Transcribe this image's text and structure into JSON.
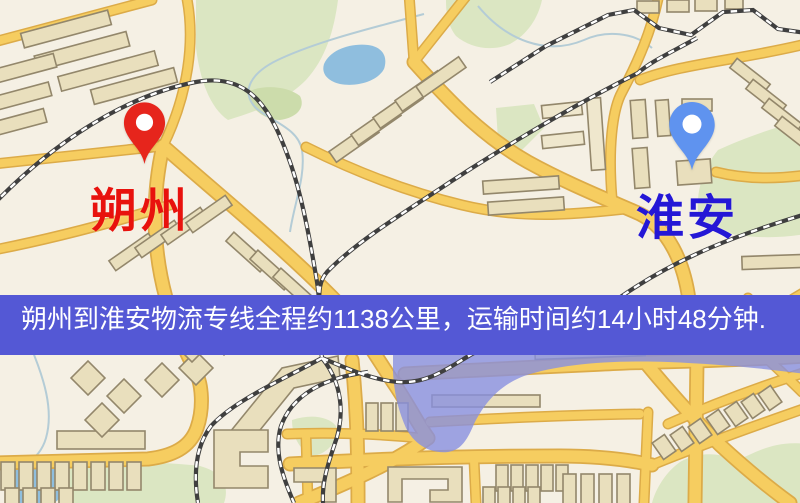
{
  "banner": {
    "text": "朔州到淮安物流专线全程约1138公里，运输时间约14小时48分钟.",
    "background": "#5458d5",
    "text_color": "#ffffff"
  },
  "markers": {
    "origin": {
      "label": "朔州",
      "pin_color": "#e6251c",
      "label_color": "#e8120d"
    },
    "destination": {
      "label": "淮安",
      "pin_color": "#5f93ef",
      "label_color": "#2417d6"
    }
  },
  "route": {
    "origin": "朔州",
    "destination": "淮安",
    "distance": "约1138公里",
    "duration": "约14小时48分钟"
  },
  "map_colors": {
    "background": "#f5f0e4",
    "road_fill": "#f6cd60",
    "road_casing": "#dcab48",
    "park": "#dbe6c2",
    "water": "#8fbede",
    "water_overlay": "#8890e0",
    "building_fill": "#e9dfbd",
    "building_stroke": "#93876b",
    "railway": "#3f3f3f"
  }
}
